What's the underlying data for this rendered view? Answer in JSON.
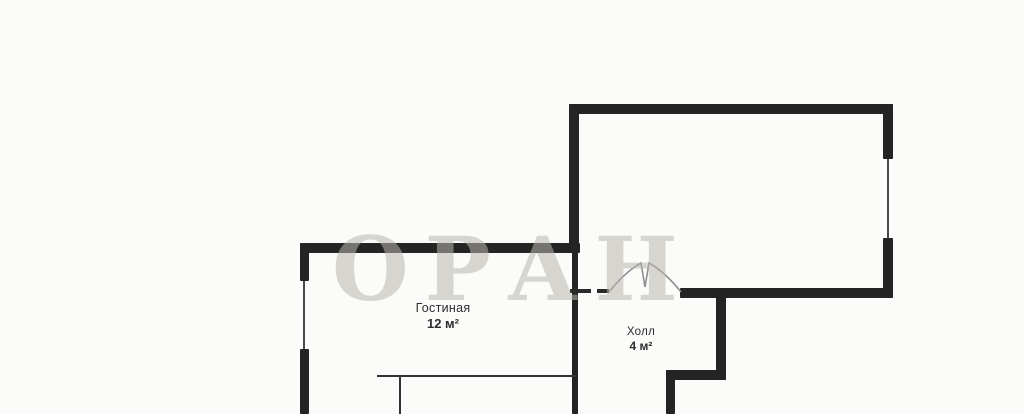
{
  "plan": {
    "watermark": "ОРАН",
    "rooms": {
      "living": {
        "name": "Гостиная",
        "area": "12 м²"
      },
      "hall": {
        "name": "Холл",
        "area": "4 м²"
      }
    },
    "colors": {
      "wall": "#242424",
      "background": "#fbfbf9",
      "label": "#2d2d2d",
      "watermark": "#b9b6af"
    },
    "features": [
      "window-living-left-wall",
      "window-upper-room-right-wall",
      "double-door-upper-room",
      "furniture-lines-living"
    ]
  }
}
